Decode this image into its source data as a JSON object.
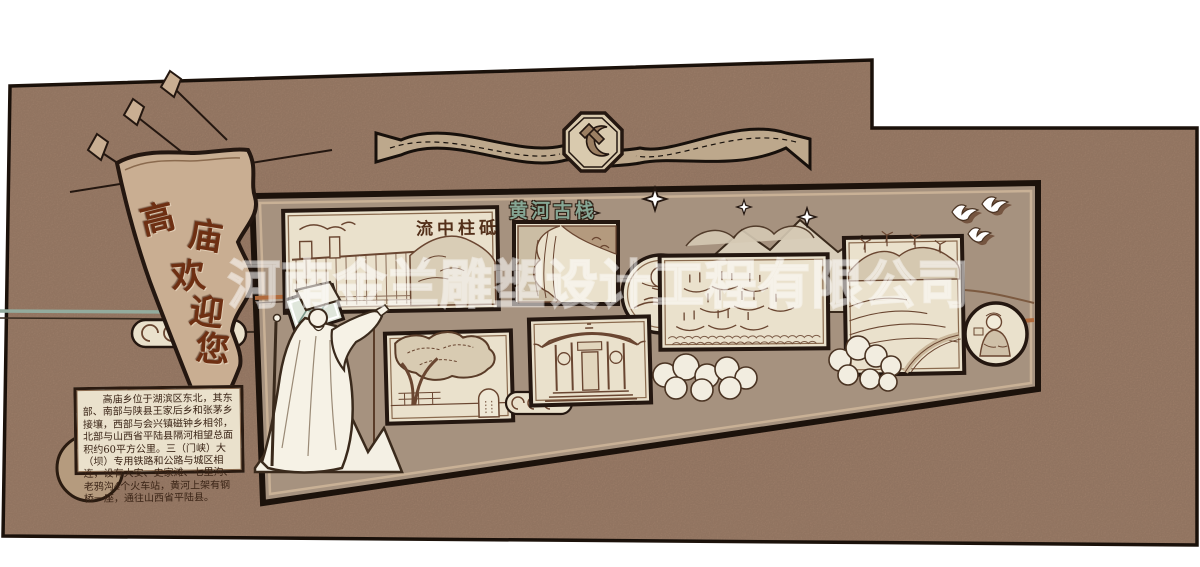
{
  "title": "高庙乡文化墙设计效果图",
  "watermark": {
    "text": "河南金兰雕塑设计工程有限公司"
  },
  "flag": {
    "text": "高庙欢迎您",
    "chars": [
      "高",
      "庙",
      "欢",
      "迎",
      "您"
    ]
  },
  "emblem": {
    "name": "中国共产党党徽",
    "symbol": "hammer-and-sickle"
  },
  "intro_board": {
    "text": "高庙乡位于湖滨区东北，其东部、南部与陕县王家后乡和张茅乡接壤，西部与会兴镇磁钟乡相邻，北部与山西省平陆县隔河相望总面积约60平方公里。三（门峡）大（坝）专用铁路和公路与城区相连，设有大安、史家滩、七里沟、老鸦沟4个火车站，黄河上架有钢桥一座，通往山西省平陆县。"
  },
  "panels": [
    {
      "id": "dam",
      "title": "流中柱砥",
      "subject": "三门峡大坝素描"
    },
    {
      "id": "plank-road",
      "title": "黄河古栈",
      "subject": "黄河古栈道崖壁素描"
    },
    {
      "id": "moon-medallion",
      "title": "",
      "subject": "圆形月夜花鸟小景"
    },
    {
      "id": "ancient-tree",
      "title": "",
      "subject": "古树与石碑素描"
    },
    {
      "id": "temple",
      "title": "",
      "subject": "高庙庙宇素描"
    },
    {
      "id": "boats",
      "title": "",
      "subject": "黄河船队素描"
    },
    {
      "id": "terraces",
      "title": "",
      "subject": "梯田风车山野素描"
    },
    {
      "id": "portrait-medallion",
      "title": "",
      "subject": "人物圆形写生"
    }
  ],
  "statue": {
    "subject": "古代先贤立像（执杖指引）"
  },
  "decor": [
    "spearhead-pennant",
    "ribbon-banner",
    "cloud-scrolls",
    "sparkles",
    "doves",
    "mountain-outlines",
    "bushes"
  ],
  "colors": {
    "wall": "#a5846e",
    "ink": "#1c120b",
    "cream": "#eae1cc",
    "sketch": "#6a4631",
    "rust": "#b06a3c",
    "teal": "#93ab9d",
    "flagfill": "#c9ae92",
    "flagtext": "#6e2f12",
    "frame": "#a6927f",
    "trim": "#c9b196",
    "ribbon": "#bda88c",
    "labelteal": "#86a795",
    "circletan": "#b59b7e",
    "page_bg": "#ffffff"
  }
}
